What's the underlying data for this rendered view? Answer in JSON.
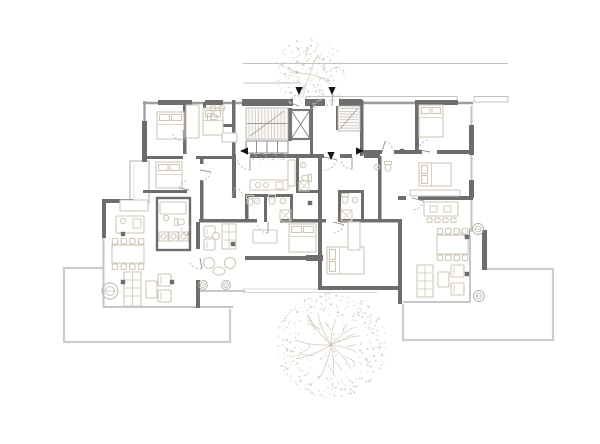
{
  "drawing": {
    "kind": "architectural-floor-plan",
    "canvas": {
      "w": 600,
      "h": 444,
      "bg": "#ffffff"
    },
    "palette": {
      "wall_dark": "#6d6d6d",
      "wall_mid": "#9f9f9f",
      "glass": "#c6c6c6",
      "terrace": "#cdcdcd",
      "step": "#d8d8d8",
      "furn": "#cfc7b8",
      "tread": "#c6c0b4",
      "tree": "#c8c0b1",
      "branch": "#d6cfc2",
      "arrow": "#141414",
      "site": "#c2c2c2",
      "white": "#ffffff"
    },
    "site_lines": [
      [
        243,
        63.5,
        508,
        63.5
      ],
      [
        243,
        83,
        301,
        83
      ]
    ],
    "canopy_strips": [
      [
        306,
        96.5,
        151,
        5.5
      ],
      [
        474,
        96.5,
        34,
        5.5
      ]
    ],
    "mid_lines": [
      [
        143,
        103,
        473,
        103
      ],
      [
        144.5,
        101,
        144.5,
        162
      ]
    ],
    "walls_dark": [
      [
        158,
        100,
        34,
        5
      ],
      [
        205,
        100,
        18,
        5
      ],
      [
        242,
        99,
        51,
        7
      ],
      [
        305,
        99,
        20,
        7
      ],
      [
        339,
        99,
        23,
        7
      ],
      [
        415,
        100,
        43,
        5
      ],
      [
        142,
        121,
        5,
        41
      ],
      [
        102,
        199,
        31,
        4
      ],
      [
        102,
        199,
        4,
        39
      ],
      [
        196,
        222,
        4,
        27
      ],
      [
        196,
        280,
        4,
        28
      ],
      [
        199,
        219,
        50,
        3.5
      ],
      [
        245,
        196,
        3.5,
        26
      ],
      [
        245,
        219,
        12,
        3.5
      ],
      [
        280,
        219,
        40,
        3.5
      ],
      [
        322,
        219,
        4,
        3.5
      ],
      [
        340,
        219,
        62,
        3.5
      ],
      [
        245,
        256,
        65,
        4
      ],
      [
        306,
        255,
        17,
        6
      ],
      [
        318,
        156,
        4,
        134
      ],
      [
        322,
        286,
        80,
        4
      ],
      [
        398,
        219,
        4,
        85
      ],
      [
        232,
        100,
        3.5,
        58
      ],
      [
        310,
        100,
        3,
        58
      ],
      [
        336,
        104,
        3,
        26
      ],
      [
        360,
        100,
        3.5,
        56
      ],
      [
        415,
        100,
        4,
        52
      ],
      [
        362,
        150,
        20,
        4
      ],
      [
        394,
        150,
        28,
        4
      ],
      [
        437,
        150,
        36,
        4
      ],
      [
        418,
        196,
        55,
        4
      ],
      [
        398,
        196,
        8,
        4
      ],
      [
        232,
        154,
        4,
        44
      ],
      [
        200,
        156,
        3.5,
        8
      ],
      [
        200,
        180,
        3.5,
        42
      ],
      [
        183,
        102,
        3.5,
        52
      ],
      [
        203,
        102,
        3,
        24
      ],
      [
        203,
        124,
        29,
        3
      ],
      [
        143,
        156,
        40,
        3
      ],
      [
        196,
        156,
        37,
        3
      ],
      [
        143,
        190,
        44,
        3
      ],
      [
        378,
        156,
        3.5,
        66
      ],
      [
        338,
        190,
        3,
        32
      ],
      [
        338,
        190,
        26,
        3
      ],
      [
        361,
        190,
        3,
        32
      ],
      [
        245,
        194,
        48,
        3
      ],
      [
        264,
        194,
        3,
        28
      ],
      [
        290,
        194,
        3,
        28
      ],
      [
        296,
        158,
        3,
        34
      ],
      [
        296,
        190,
        24,
        3
      ],
      [
        250,
        154,
        74,
        4
      ],
      [
        340,
        154,
        12,
        4
      ],
      [
        364,
        154,
        16,
        4
      ],
      [
        288,
        108,
        4,
        33
      ],
      [
        469,
        125,
        5,
        30
      ],
      [
        469,
        180,
        5,
        18
      ],
      [
        482,
        230,
        5,
        40
      ]
    ],
    "wall_boxes": [
      [
        157,
        198,
        33,
        52
      ]
    ],
    "entry_gaps_white": [
      [
        293,
        99,
        12,
        7
      ],
      [
        325,
        99,
        14,
        7
      ]
    ],
    "glass_lines": [
      [
        103.5,
        238,
        103.5,
        307
      ],
      [
        103,
        307,
        233,
        307
      ],
      [
        471.5,
        106,
        471.5,
        232
      ],
      [
        470,
        235,
        470,
        302
      ],
      [
        403,
        302,
        470,
        302
      ],
      [
        486,
        236,
        486,
        268
      ],
      [
        198,
        291,
        245,
        291
      ]
    ],
    "bay_window": [
      130,
      161,
      19,
      42
    ],
    "terrace_paths": [
      "M103,268 L64,268 L64,342 L230,342 L230,309",
      "M486,236 L486,269 L553,269 L553,340 L403,340 L403,304"
    ],
    "step_lines": [
      [
        243,
        289,
        377,
        289
      ],
      [
        243,
        292.5,
        377,
        292.5
      ]
    ],
    "stair_main": {
      "x": 246,
      "y": 108,
      "w": 42,
      "h": 31
    },
    "stair_side": {
      "x": 338,
      "y": 106,
      "w": 22,
      "h": 25
    },
    "understair": {
      "x": 246,
      "y": 141,
      "w": 42,
      "h": 12,
      "cells": 4
    },
    "understair_arcs": [
      [
        250,
        153,
        7
      ],
      [
        260,
        153,
        7
      ],
      [
        270,
        153,
        7
      ],
      [
        280,
        153,
        7
      ]
    ],
    "elevator": {
      "x": 291,
      "y": 110,
      "w": 19,
      "h": 29
    },
    "beds": [
      [
        157,
        112,
        27,
        27,
        "N"
      ],
      [
        203,
        108,
        20,
        27,
        "N"
      ],
      [
        156,
        162,
        26,
        26,
        "N"
      ],
      [
        419,
        105,
        24,
        32,
        "N"
      ],
      [
        419,
        163,
        32,
        23,
        "W"
      ],
      [
        289,
        224,
        27,
        28,
        "N"
      ],
      [
        327,
        247,
        37,
        27,
        "W"
      ]
    ],
    "tan_rects": [
      [
        186,
        105,
        13,
        33
      ],
      [
        120,
        200,
        28,
        11
      ],
      [
        116,
        216,
        28,
        17
      ],
      [
        253,
        230,
        24,
        13
      ],
      [
        250,
        180,
        38,
        10
      ],
      [
        410,
        190,
        50,
        6
      ],
      [
        424,
        202,
        34,
        14
      ],
      [
        146,
        281,
        11,
        17
      ],
      [
        438,
        272,
        11,
        15
      ],
      [
        160,
        202,
        26,
        12
      ],
      [
        222,
        133,
        15,
        9
      ],
      [
        348,
        222,
        12,
        28
      ],
      [
        288,
        160,
        7,
        26
      ]
    ],
    "kitchen_inners": {
      "circles": [
        [
          123,
          221,
          2.8
        ],
        [
          258,
          185,
          2.6
        ],
        [
          266,
          185,
          2.6
        ]
      ],
      "rects": [
        [
          133,
          219,
          8,
          9
        ],
        [
          276,
          182,
          7,
          7
        ],
        [
          430,
          206,
          7,
          6
        ],
        [
          444,
          206,
          7,
          6
        ]
      ]
    },
    "dining": [
      {
        "t": [
          112,
          245,
          32,
          18
        ],
        "rows": 2,
        "n": 4
      },
      {
        "t": [
          437,
          235,
          31,
          19
        ],
        "rows": 2,
        "n": 4
      }
    ],
    "sofas": [
      [
        124,
        272,
        17,
        34
      ],
      [
        417,
        265,
        16,
        32
      ],
      [
        222,
        224,
        14,
        25
      ]
    ],
    "armchairs": [
      [
        158,
        274,
        13,
        12
      ],
      [
        158,
        290,
        13,
        12
      ],
      [
        451,
        265,
        13,
        12
      ],
      [
        451,
        283,
        13,
        12
      ],
      [
        204,
        226,
        11,
        11
      ],
      [
        204,
        239,
        11,
        11
      ]
    ],
    "round_tables": [
      [
        219,
        271,
        6,
        4
      ],
      [
        216,
        236,
        3.5,
        3.5
      ]
    ],
    "out_chairs": [
      [
        209,
        263
      ],
      [
        230,
        263
      ]
    ],
    "island_stools": [
      [
        427,
        218
      ],
      [
        435,
        218
      ],
      [
        443,
        218
      ],
      [
        451,
        218
      ]
    ],
    "plants": [
      [
        110,
        291,
        8
      ],
      [
        203,
        285,
        4.5
      ],
      [
        226,
        285,
        4.5
      ],
      [
        478,
        229,
        5.5
      ],
      [
        479,
        296,
        5.5
      ]
    ],
    "fixtures": {
      "wc": [
        [
          181,
          222,
          "W"
        ],
        [
          250,
          202,
          "N"
        ],
        [
          272,
          201,
          "N"
        ],
        [
          305,
          178,
          "E"
        ],
        [
          345,
          200,
          "N"
        ],
        [
          388,
          168,
          "N"
        ],
        [
          214,
          117,
          "W"
        ]
      ],
      "sink": [
        [
          166,
          218
        ],
        [
          257,
          201
        ],
        [
          283,
          201
        ],
        [
          303,
          165
        ],
        [
          355,
          200
        ],
        [
          377,
          167
        ],
        [
          213,
          108
        ],
        [
          222,
          108
        ]
      ],
      "shower": [
        [
          280,
          210,
          11
        ],
        [
          341,
          210,
          11
        ],
        [
          299,
          181,
          10
        ]
      ],
      "washer": [
        [
          159,
          232
        ],
        [
          169,
          232
        ],
        [
          179,
          232
        ]
      ]
    },
    "door_arcs": [
      [
        250,
        157,
        13,
        90,
        168
      ],
      [
        324,
        157,
        13,
        12,
        90
      ],
      [
        352,
        157,
        12,
        90,
        168
      ],
      [
        299,
        106,
        11,
        200,
        268
      ],
      [
        332,
        106,
        11,
        272,
        340
      ],
      [
        183,
        130,
        11,
        86,
        160
      ],
      [
        200,
        170,
        11,
        10,
        86
      ],
      [
        189,
        190,
        10,
        192,
        264
      ],
      [
        232,
        198,
        11,
        284,
        352
      ],
      [
        268,
        222,
        11,
        90,
        166
      ],
      [
        333,
        222,
        11,
        14,
        90
      ],
      [
        412,
        198,
        12,
        14,
        88
      ],
      [
        430,
        152,
        12,
        192,
        258
      ],
      [
        382,
        152,
        11,
        286,
        352
      ],
      [
        200,
        258,
        11,
        80,
        156
      ],
      [
        190,
        226,
        9,
        100,
        176
      ],
      [
        470,
        228,
        10,
        96,
        170
      ]
    ],
    "columns": [
      [
        123,
        234
      ],
      [
        233,
        244
      ],
      [
        123,
        282
      ],
      [
        172,
        282
      ],
      [
        310,
        203
      ],
      [
        402,
        151
      ],
      [
        467,
        237
      ],
      [
        467,
        274
      ]
    ],
    "arrows": [
      {
        "x": 299,
        "y": 91,
        "dir": "down",
        "name": "entry-arrow-left"
      },
      {
        "x": 332,
        "y": 91,
        "dir": "down",
        "name": "entry-arrow-right"
      },
      {
        "x": 244,
        "y": 151,
        "dir": "left",
        "name": "apartment-entry-arrow-west"
      },
      {
        "x": 331,
        "y": 156,
        "dir": "down",
        "name": "apartment-entry-arrow-south"
      },
      {
        "x": 360,
        "y": 151,
        "dir": "right",
        "name": "apartment-entry-arrow-east"
      }
    ],
    "trees": [
      {
        "cx": 310,
        "cy": 74,
        "r": 37,
        "seed": 11,
        "branches": 4,
        "inner": 0.12,
        "name": "tree-canopy-top"
      },
      {
        "cx": 331,
        "cy": 345,
        "r": 55,
        "seed": 29,
        "branches": 11,
        "inner": 0.5,
        "core": true,
        "name": "tree-canopy-bottom"
      }
    ]
  }
}
